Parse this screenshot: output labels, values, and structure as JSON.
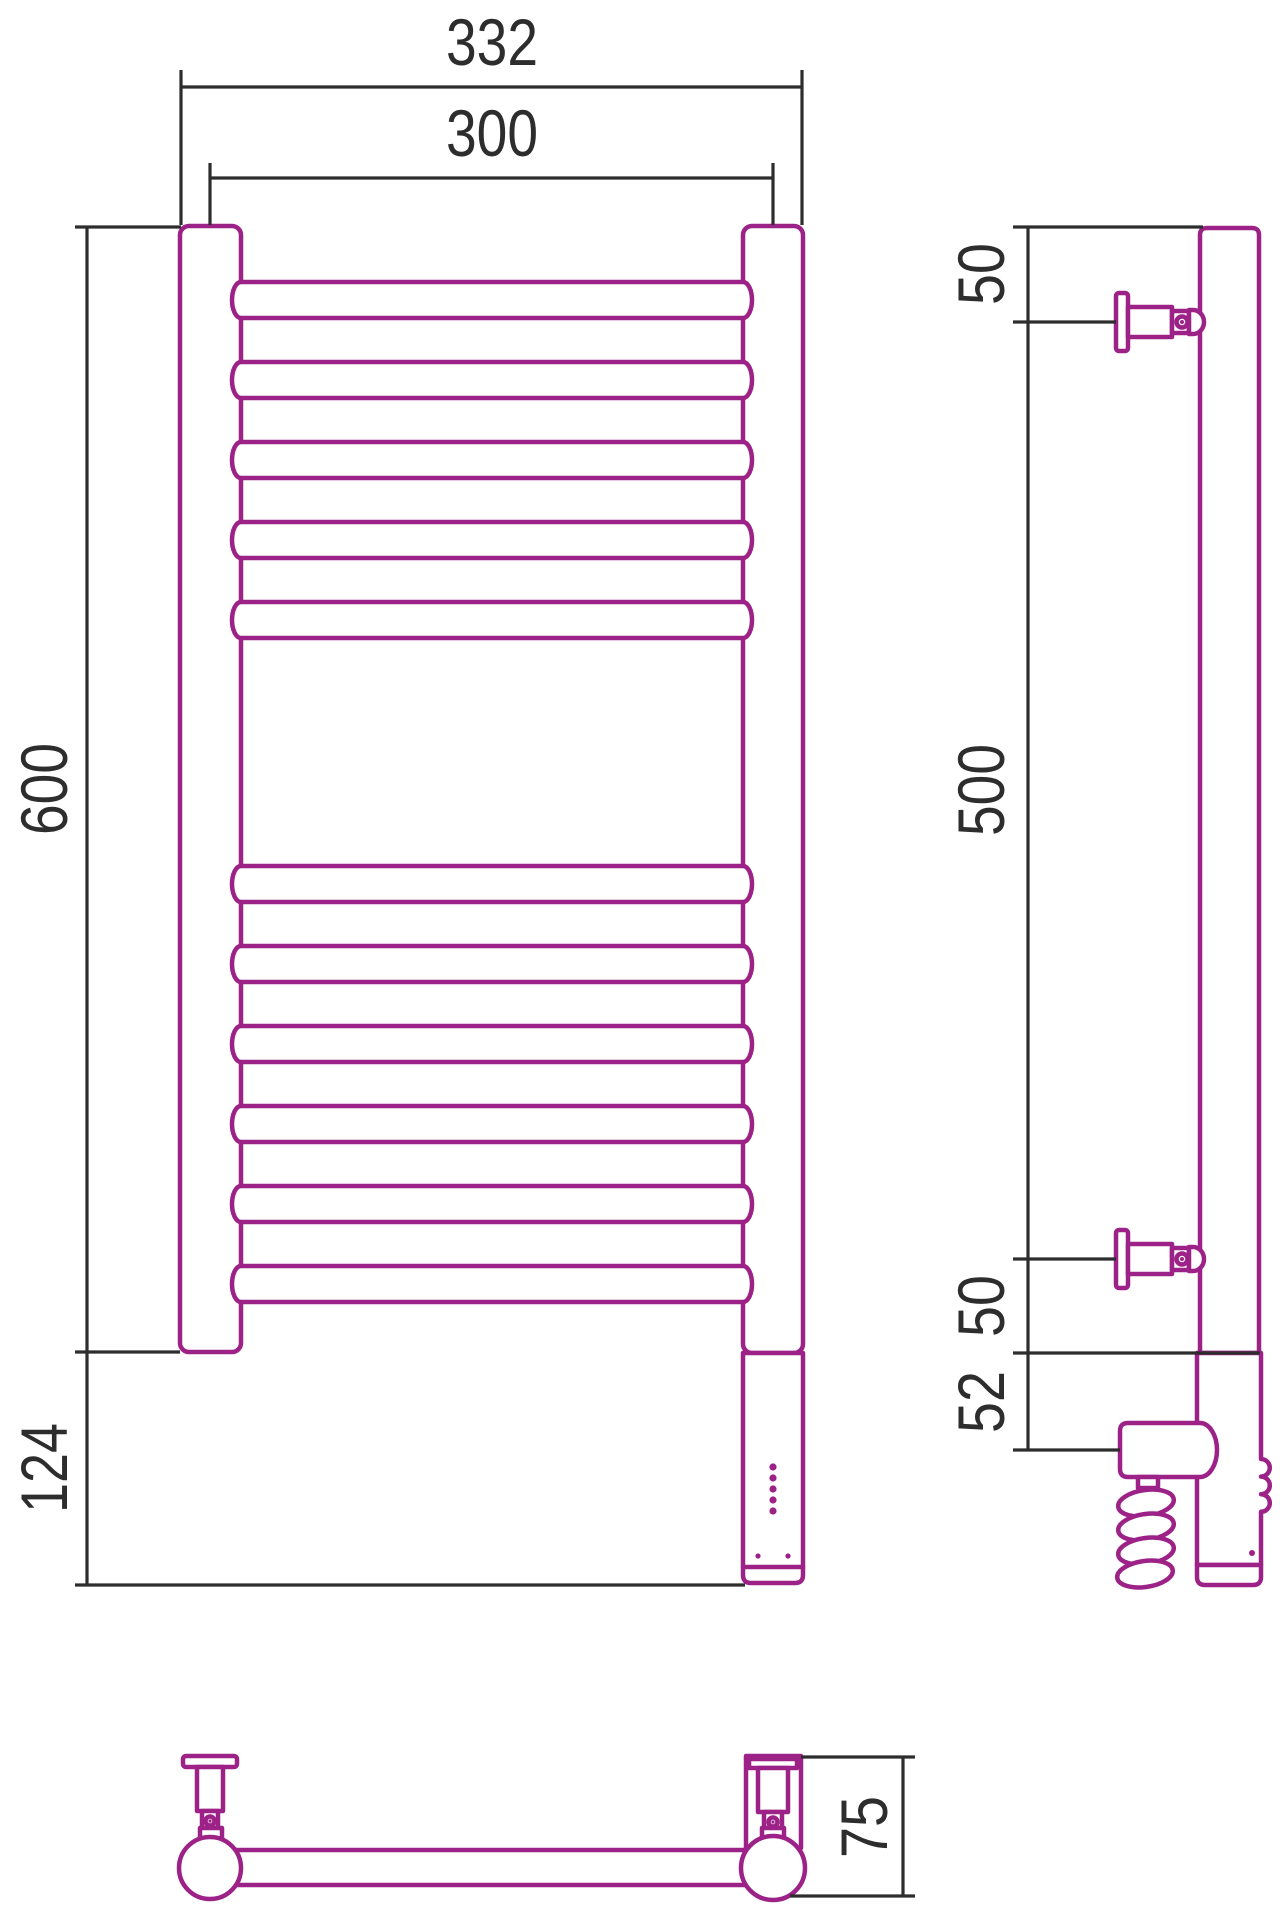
{
  "drawing": {
    "subject": "wall heated towel rail - dimensional drawing",
    "colors": {
      "product_outline": "#9C2288",
      "dimension_lines": "#2D2D2D",
      "background": "#FFFFFF"
    },
    "views": {
      "front": {
        "dims": {
          "overall_width": "332",
          "rail_axis_width": "300",
          "height": "600",
          "heater_extension": "124"
        },
        "rungs_top_group": 5,
        "rungs_bottom_group": 6,
        "indicator_dots": 5
      },
      "side": {
        "dims": {
          "top_bracket_offset": "50",
          "bracket_spacing": "500",
          "bottom_bracket_offset": "50",
          "plug_offset": "52"
        }
      },
      "plan": {
        "dims": {
          "depth": "75"
        }
      }
    }
  }
}
